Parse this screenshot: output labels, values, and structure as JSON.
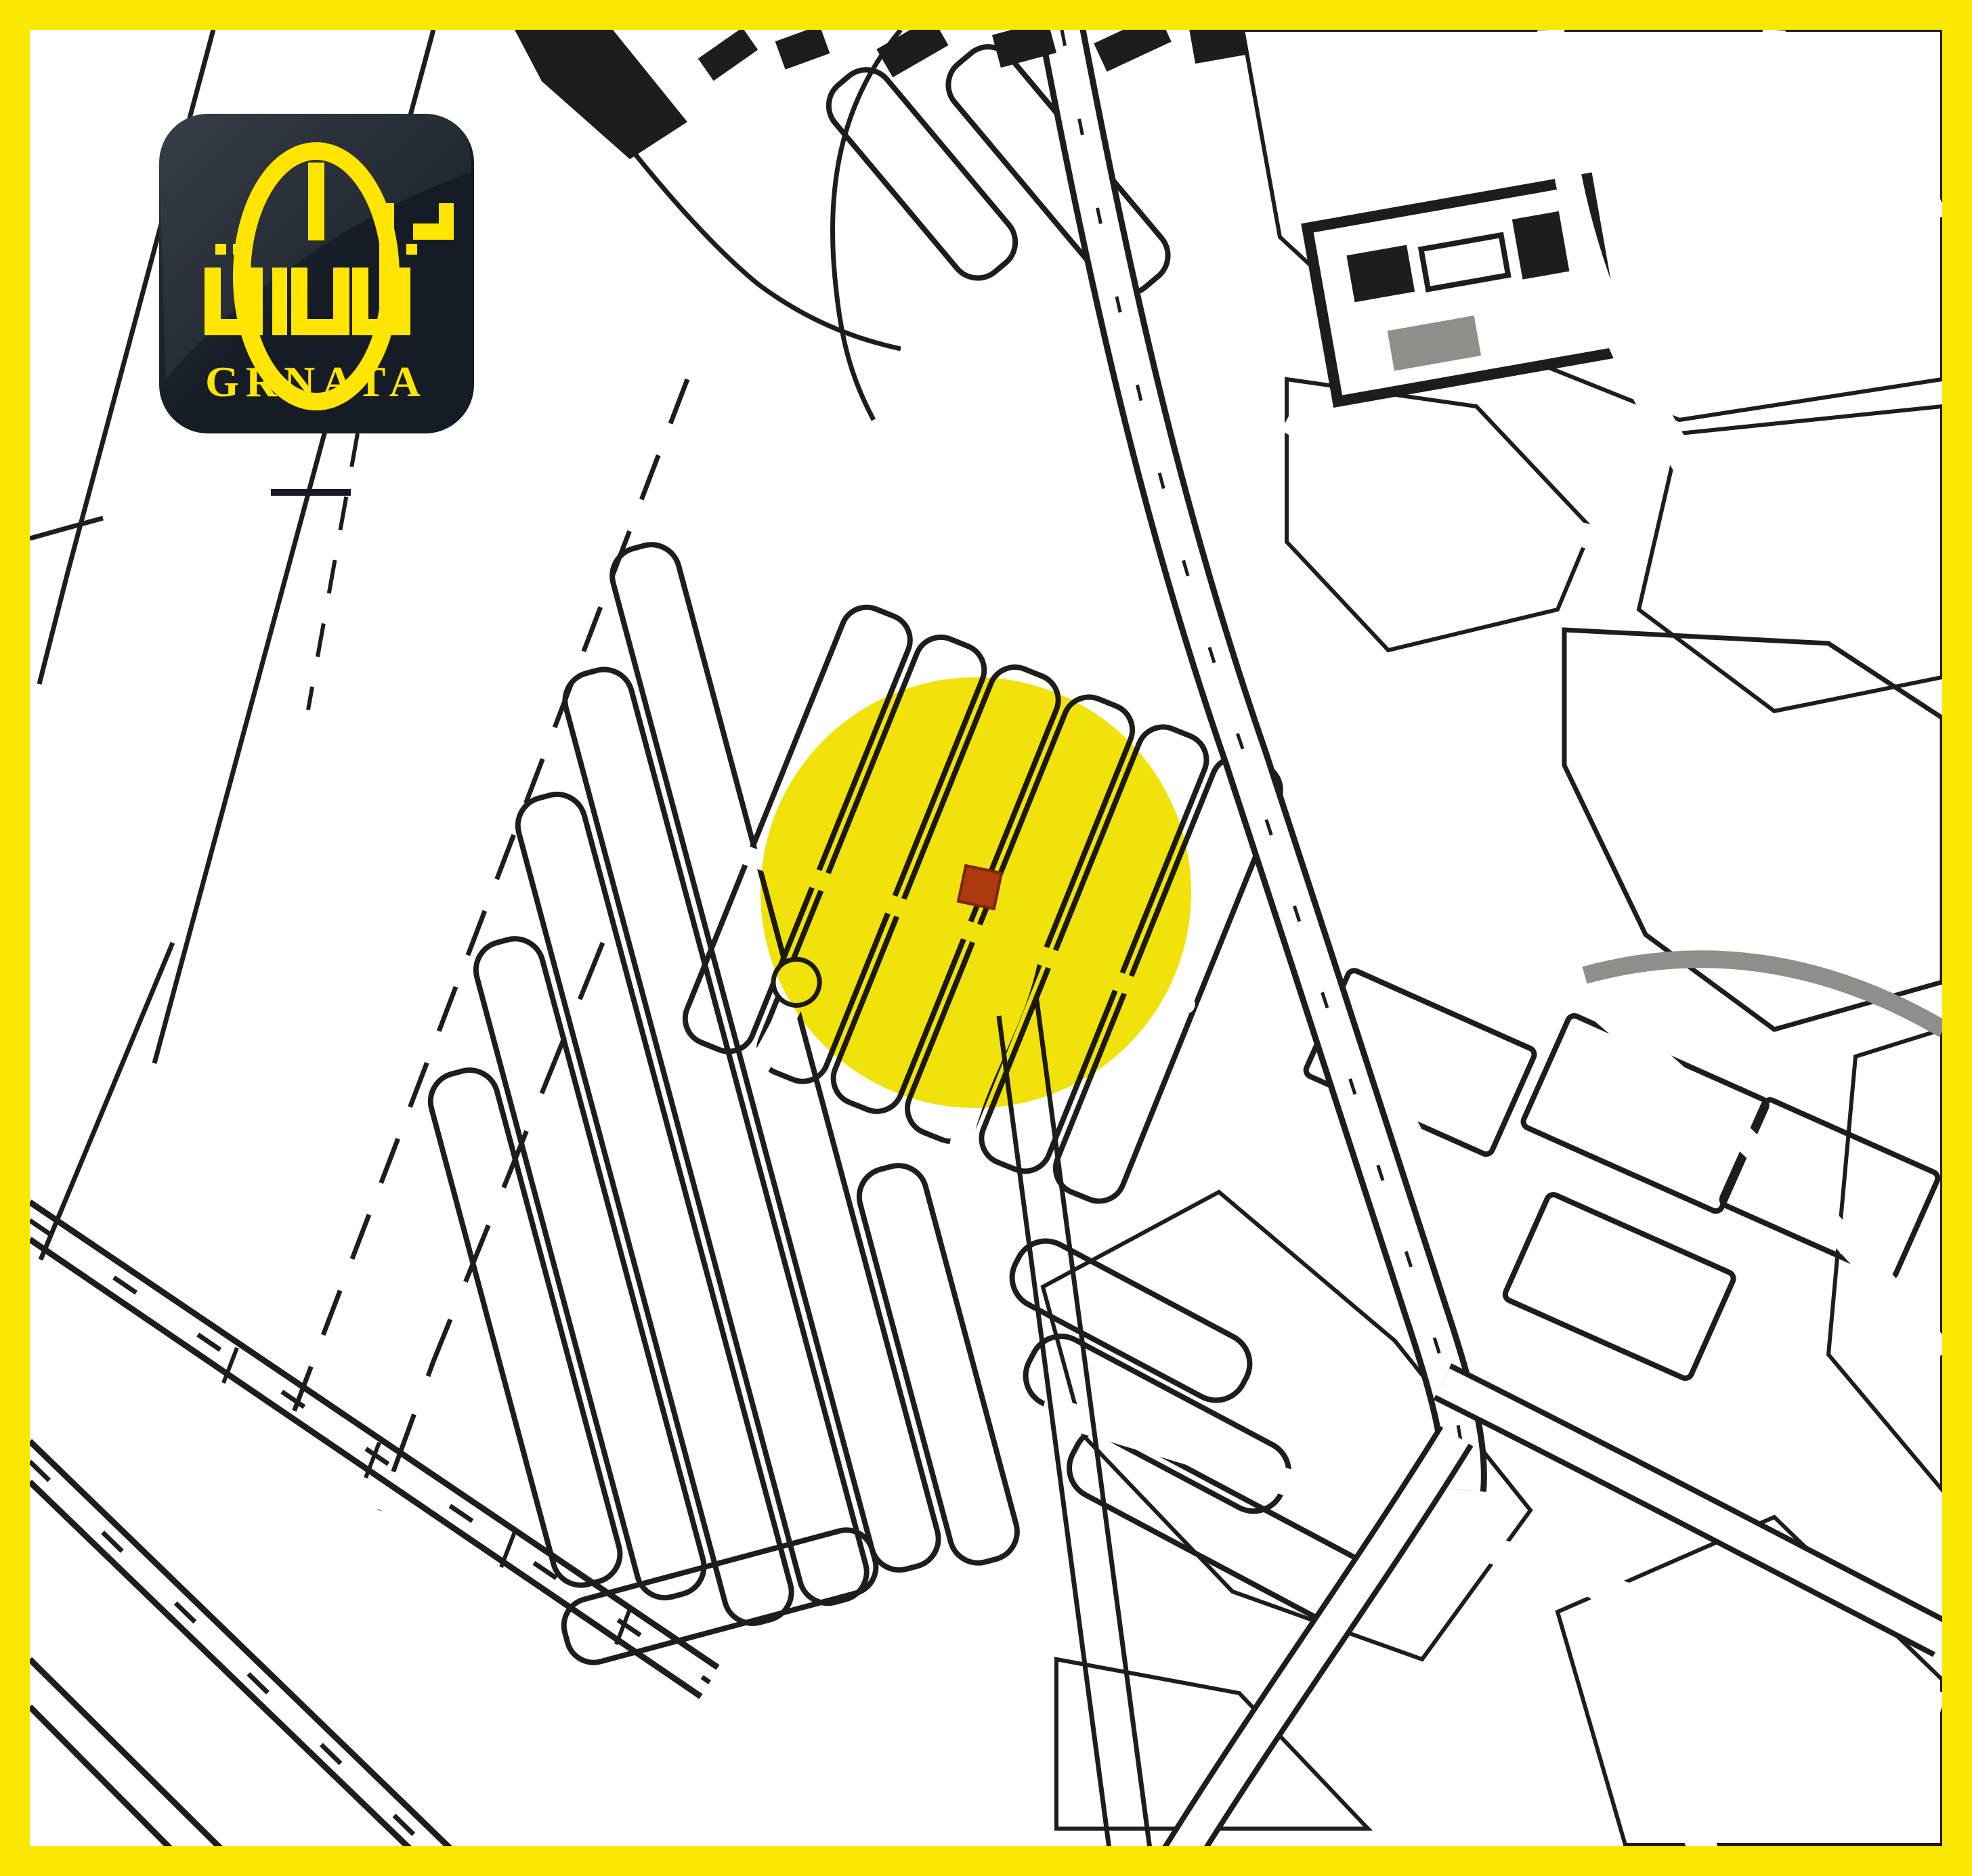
{
  "brand": {
    "name_arabic": "غرناطة",
    "name_latin": "GRNATA"
  },
  "colors": {
    "frame": "#FAE800",
    "paper": "#FFFFFF",
    "line": "#1D1D1B",
    "highlight": "#F0E20A",
    "marker": "#AC3A0E",
    "marker_edge": "#7A2606",
    "logo_bg": "#151C26",
    "logo_bg_light": "#2B323C",
    "logo_accent": "#FFE500",
    "stipple": "#9B9B97",
    "road_gray": "#8E8E8A"
  },
  "map": {
    "kind": "black-and-white cadastral street plan",
    "highlight_shape": "circle",
    "marker_shape": "square"
  }
}
